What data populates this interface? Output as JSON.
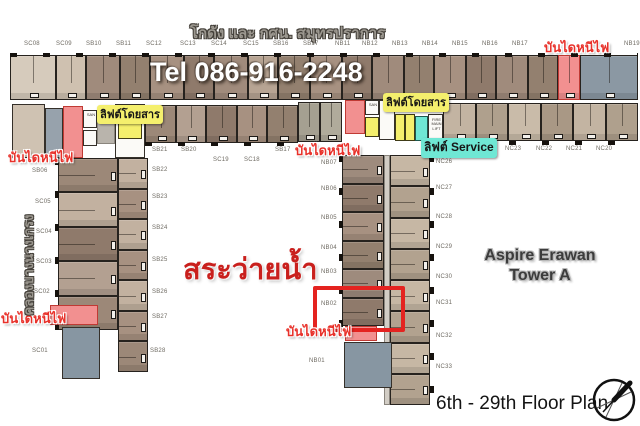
{
  "header": {
    "site_label": "โกดัง และ กศน. สมุทรปราการ",
    "phone": "Tel 086-916-2248"
  },
  "labels": {
    "fire_escape": "บันไดหนีไฟ",
    "passenger_lift": "ลิฟต์โดยสาร",
    "service_lift": "ลิฟต์ Service",
    "pool": "สระว่ายน้ำ",
    "canal": "คลองบางนางเกรง",
    "tower_line1": "Aspire Erawan",
    "tower_line2": "Tower A",
    "floor_plan": "6th - 29th Floor Plan",
    "san": "SAN",
    "fire_main_lift": "FIRE MAIN LIFT"
  },
  "units": {
    "top_row": [
      "SC08",
      "SC09",
      "SB10",
      "SB11",
      "SC12",
      "SC13",
      "SC14",
      "SC15",
      "SB16",
      "SB17",
      "NB11",
      "NB12",
      "NB13",
      "NB14",
      "NB15",
      "NB16",
      "NB17",
      "NB19"
    ],
    "mid_row_left": [
      "SB21",
      "SB20",
      "SC19",
      "SC18",
      "SB17"
    ],
    "mid_row_right": [
      "NC23",
      "NC22",
      "NC21",
      "NC20"
    ],
    "left_wing_west": [
      "SB06",
      "SC05",
      "SC04",
      "SC03",
      "SC02",
      "SC01"
    ],
    "left_wing_east": [
      "SB22",
      "SB23",
      "SB24",
      "SB25",
      "SB26",
      "SB27",
      "SB28"
    ],
    "center_wing_west": [
      "NB07",
      "NB06",
      "NB05",
      "NB04",
      "NB03",
      "NB02",
      "NB01"
    ],
    "center_wing_east": [
      "NC26",
      "NC27",
      "NC28",
      "NC29",
      "NC30",
      "NC31",
      "NC32",
      "NC33"
    ]
  },
  "colors": {
    "stair_highlight": "#f29090",
    "passenger_lift_highlight": "#f4ef6d",
    "service_lift_highlight": "#6fe7d4",
    "selection_box": "#e42320",
    "pool_text": "#c9201d",
    "fire_escape_text": "#e8312a",
    "unit_brown": "#9c8878",
    "unit_tan": "#c3b4a2",
    "unit_bluegray": "#8b98a3"
  }
}
